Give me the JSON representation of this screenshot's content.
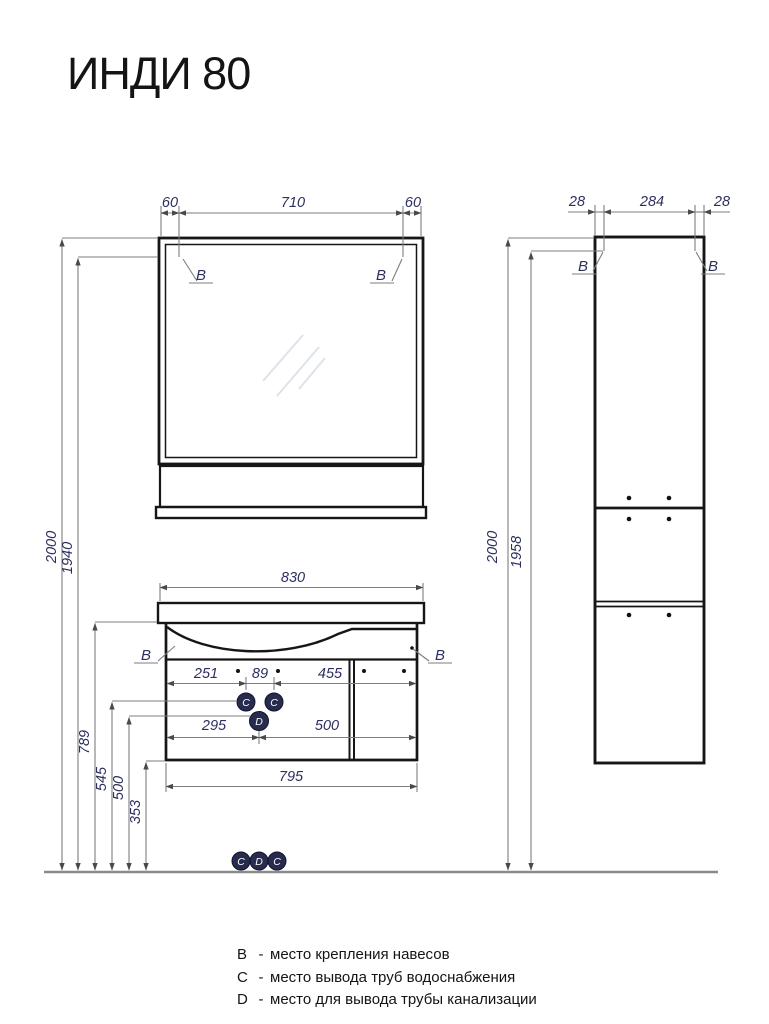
{
  "title": "ИНДИ 80",
  "colors": {
    "drawing_line": "#161616",
    "dimension_line": "#7e7e7e",
    "dimension_text": "#2c2f5e",
    "marker_fill": "#272b4e",
    "marker_text": "#ffffff"
  },
  "dimensions": {
    "mirror_top": {
      "left": "60",
      "middle": "710",
      "right": "60"
    },
    "tall_top": {
      "left": "28",
      "middle": "284",
      "right": "28"
    },
    "left_heights": {
      "total": "2000",
      "mount": "1940",
      "sink_top": "789",
      "water": "545",
      "drain": "500",
      "bottom": "353"
    },
    "right_heights": {
      "total": "2000",
      "mount": "1958"
    },
    "vanity": {
      "width_top": "830",
      "row1_a": "251",
      "row1_b": "89",
      "row1_c": "455",
      "row2_a": "295",
      "row2_b": "500",
      "width_bottom": "795"
    }
  },
  "markers": {
    "b": "B",
    "c": "C",
    "d": "D"
  },
  "legend": {
    "rows": [
      {
        "key": "B",
        "dash": "-",
        "text": "место крепления навесов"
      },
      {
        "key": "C",
        "dash": "-",
        "text": "место вывода труб водоснабжения"
      },
      {
        "key": "D",
        "dash": "-",
        "text": "место для вывода трубы канализации"
      }
    ]
  }
}
